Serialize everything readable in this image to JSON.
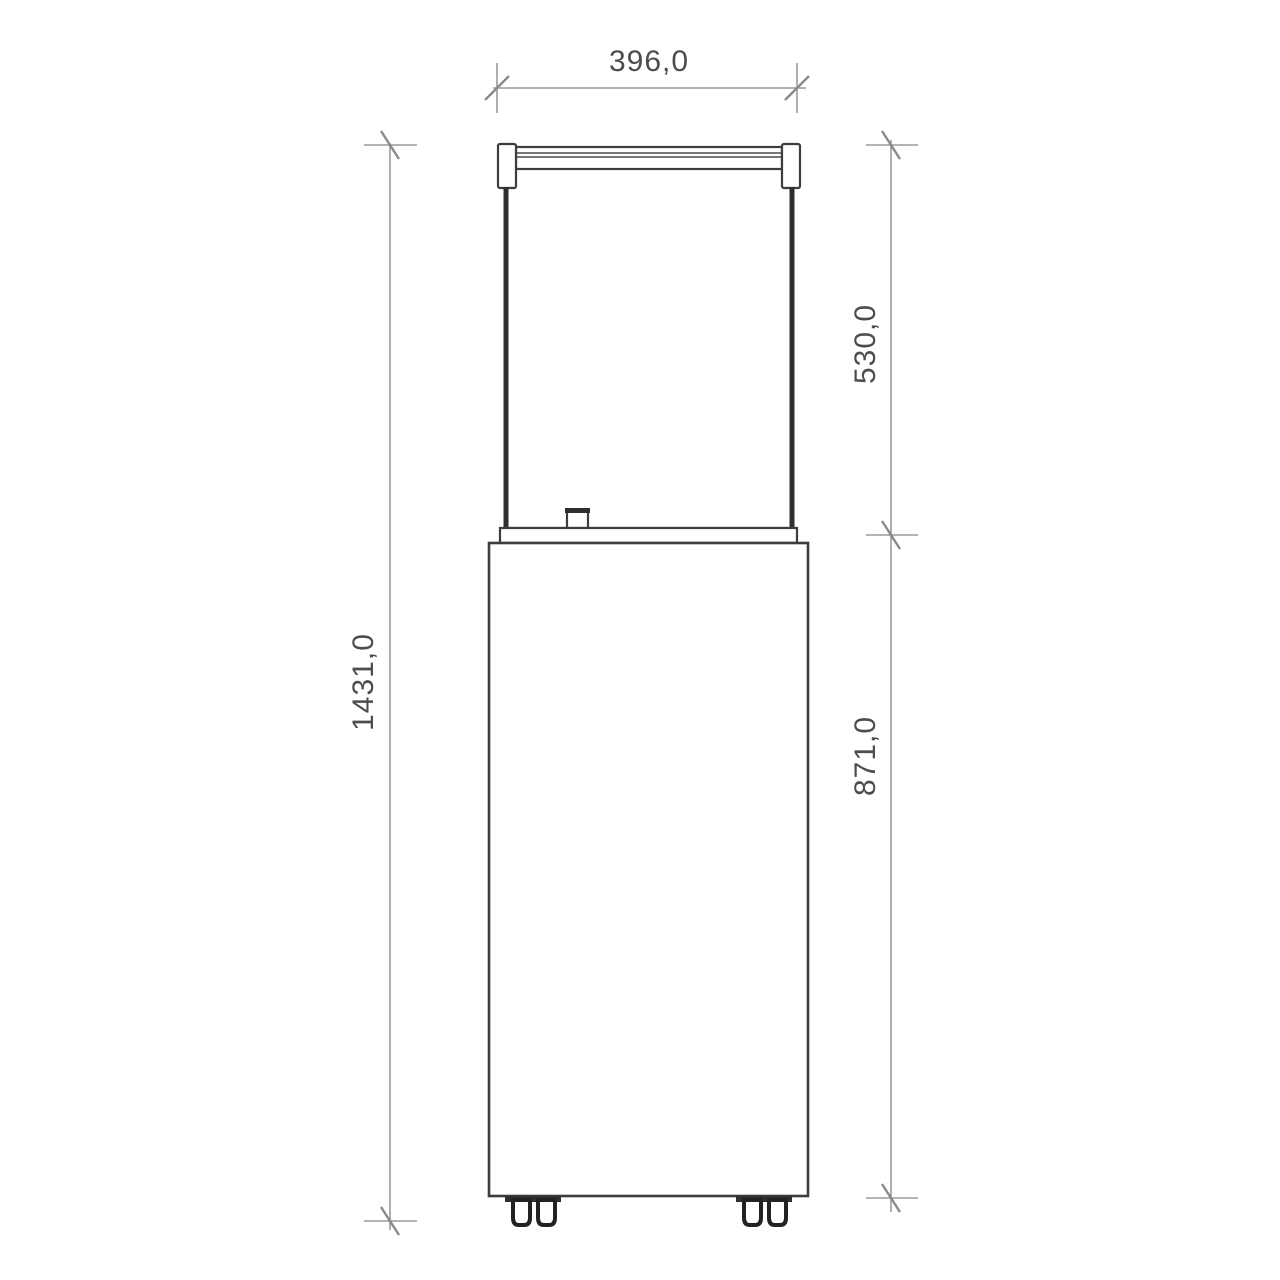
{
  "figure": {
    "type": "technical-dimension-drawing",
    "view": "front elevation",
    "subject": "floor-standing gas patio heater with glass flame enclosure, top rail and base cabinet on casters"
  },
  "dimensions": {
    "width": {
      "value": "396,0",
      "orientation": "horizontal"
    },
    "upper_height": {
      "value": "530,0",
      "orientation": "vertical"
    },
    "lower_height": {
      "value": "871,0",
      "orientation": "vertical"
    },
    "total_height": {
      "value": "1431,0",
      "orientation": "vertical"
    }
  },
  "colors": {
    "background": "#ffffff",
    "object_line": "#3d3d3d",
    "glass_edge_line": "#2f2f2f",
    "dimension_line": "#9a9a9a",
    "label_text": "#4d4d4d"
  }
}
